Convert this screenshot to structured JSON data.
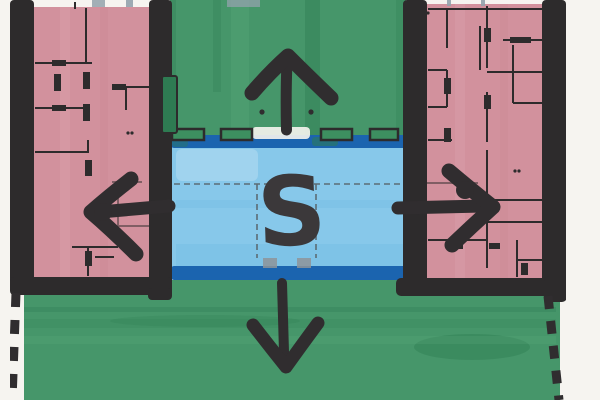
{
  "sketch": {
    "center_label": "S",
    "ink": "#302d2f",
    "pencil": "#5c6c74",
    "zones": {
      "paper": {
        "name": "paper-background",
        "color": "#f6f4f0"
      },
      "courtyard_top": {
        "name": "green-courtyard-top",
        "color": "#46966a"
      },
      "lawn_bottom": {
        "name": "green-lawn-bottom",
        "color": "#46966a"
      },
      "water": {
        "name": "central-water-court",
        "color": "#87c8ea",
        "edge_color": "#1b64af"
      },
      "left_wing": {
        "name": "left-building-wing",
        "color": "#d2919d"
      },
      "right_wing": {
        "name": "right-building-wing",
        "color": "#d2919d"
      },
      "walls": {
        "name": "building-walls",
        "color": "#2d2b2c"
      },
      "hedge": {
        "name": "hedge-box",
        "color": "#2e7b52"
      },
      "planter": {
        "name": "planter-box",
        "color": "#3d8f60"
      }
    },
    "arrows": [
      {
        "id": "arrow-up-icon",
        "direction": "up"
      },
      {
        "id": "arrow-left-icon",
        "direction": "left"
      },
      {
        "id": "arrow-right-icon",
        "direction": "right"
      },
      {
        "id": "arrow-down-icon",
        "direction": "down"
      }
    ],
    "marks": {
      "vault_gray": "#8e9499",
      "tape_gray": "#93a2ac"
    }
  }
}
